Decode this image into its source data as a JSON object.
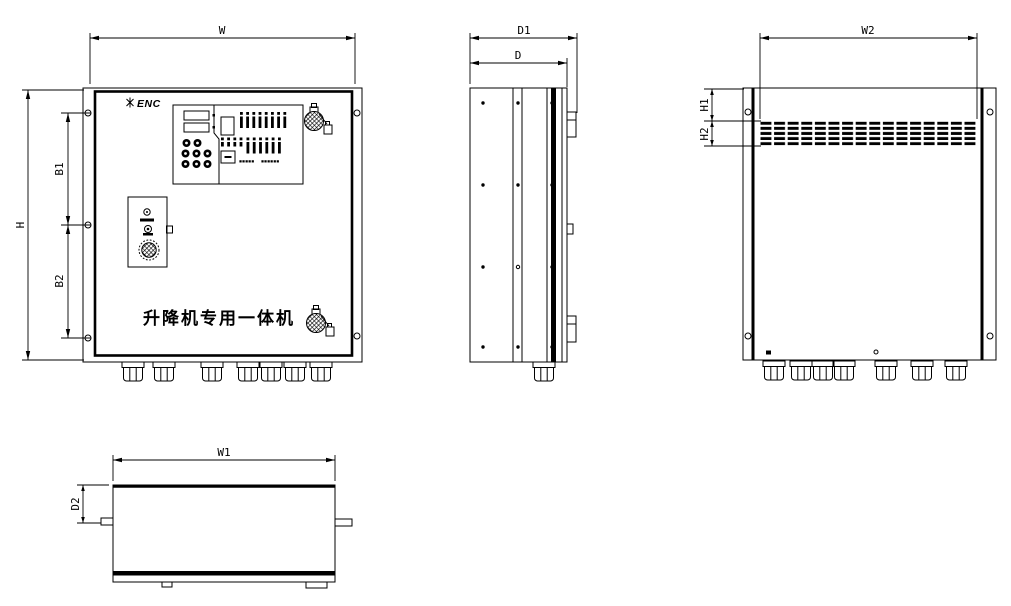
{
  "colors": {
    "background": "#ffffff",
    "ink": "#000000"
  },
  "front_view": {
    "logo_text": "ENC",
    "title": "升降机专用一体机",
    "keypad": {
      "caption_left": "▪▪▪▪▪",
      "caption_right": "▪▪▪▪▪▪"
    }
  },
  "dims": {
    "w": "W",
    "d1": "D1",
    "d": "D",
    "w2": "W2",
    "h": "H",
    "b1": "B1",
    "b2": "B2",
    "h1": "H1",
    "h2": "H2",
    "w1": "W1",
    "d2": "D2"
  }
}
